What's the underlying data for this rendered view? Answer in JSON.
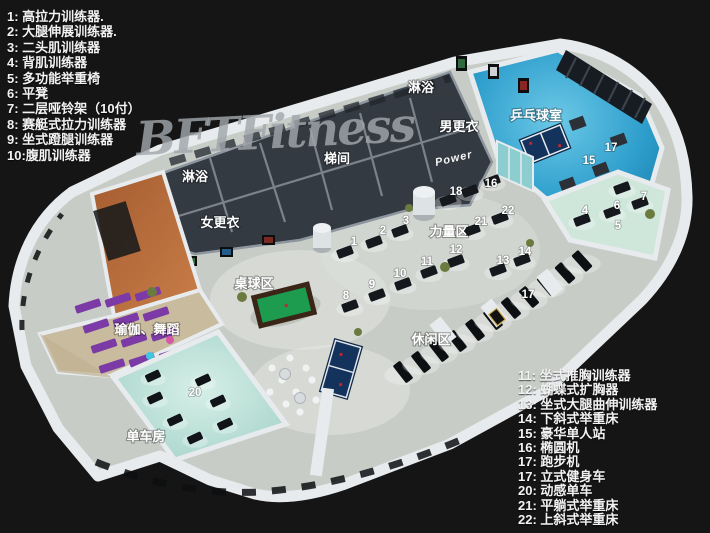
{
  "watermark": "BFTFitness",
  "legend_left": {
    "items": [
      "1:  高拉力训练器.",
      "2:  大腿伸展训练器.",
      "3:  二头肌训练器",
      "4:  背肌训练器",
      "5: 多功能举重椅",
      "6:  平凳",
      "7:  二层哑铃架（10付）",
      "8:  赛艇式拉力训练器",
      "9:  坐式蹬腿训练器",
      "10:腹肌训练器"
    ]
  },
  "legend_right": {
    "items": [
      "11: 坐式推胸训练器",
      "12: 蝴蝶式扩胸器",
      "13: 坐式大腿曲伸训练器",
      "14: 下斜式举重床",
      "15: 豪华单人站",
      "16: 椭圆机",
      "17: 跑步机",
      "17: 立式健身车",
      "20: 动感单车",
      "21: 平躺式举重床",
      "22: 上斜式举重床"
    ]
  },
  "floorplan": {
    "power_sign": "Power",
    "labels": [
      {
        "text": "淋浴",
        "x": 421,
        "y": 92
      },
      {
        "text": "男更衣",
        "x": 459,
        "y": 131
      },
      {
        "text": "乒乓球室",
        "x": 536,
        "y": 120
      },
      {
        "text": "梯间",
        "x": 337,
        "y": 163
      },
      {
        "text": "淋浴",
        "x": 195,
        "y": 181
      },
      {
        "text": "女更衣",
        "x": 220,
        "y": 227
      },
      {
        "text": "桌球区",
        "x": 254,
        "y": 288
      },
      {
        "text": "力量区",
        "x": 449,
        "y": 236
      },
      {
        "text": "休闲区",
        "x": 431,
        "y": 344
      },
      {
        "text": "瑜伽、舞蹈",
        "x": 147,
        "y": 334
      },
      {
        "text": "单车房",
        "x": 146,
        "y": 441
      }
    ],
    "markers": [
      {
        "n": "1",
        "x": 354,
        "y": 245
      },
      {
        "n": "2",
        "x": 383,
        "y": 234
      },
      {
        "n": "3",
        "x": 406,
        "y": 224
      },
      {
        "n": "4",
        "x": 585,
        "y": 214
      },
      {
        "n": "5",
        "x": 618,
        "y": 229
      },
      {
        "n": "6",
        "x": 617,
        "y": 209
      },
      {
        "n": "7",
        "x": 644,
        "y": 200
      },
      {
        "n": "8",
        "x": 346,
        "y": 299
      },
      {
        "n": "9",
        "x": 372,
        "y": 288
      },
      {
        "n": "10",
        "x": 400,
        "y": 277
      },
      {
        "n": "11",
        "x": 427,
        "y": 265
      },
      {
        "n": "12",
        "x": 456,
        "y": 253
      },
      {
        "n": "13",
        "x": 503,
        "y": 264
      },
      {
        "n": "14",
        "x": 525,
        "y": 255
      },
      {
        "n": "15",
        "x": 589,
        "y": 164
      },
      {
        "n": "16",
        "x": 491,
        "y": 187
      },
      {
        "n": "17",
        "x": 611,
        "y": 151
      },
      {
        "n": "17",
        "x": 528,
        "y": 298
      },
      {
        "n": "18",
        "x": 456,
        "y": 195
      },
      {
        "n": "20",
        "x": 195,
        "y": 396
      },
      {
        "n": "21",
        "x": 481,
        "y": 225
      },
      {
        "n": "22",
        "x": 508,
        "y": 214
      }
    ]
  },
  "colors": {
    "background": "#151515",
    "main_floor": "#c8ccc7",
    "wall_white": "#e7ebed",
    "dark_rooms": "#343a41",
    "blue_floor": "#2f9fcd",
    "mint_floor": "#cfe6db",
    "bike_floor": "#b7ddd4",
    "orange_floor": "#b96f3e",
    "wood_floor": "#c8bb9e",
    "purple_mat": "#7c3aa6",
    "pool_table_green": "#1d9b4e",
    "pingpong_table_navy": "#14335c",
    "legend_text": "#f2f2f2"
  }
}
